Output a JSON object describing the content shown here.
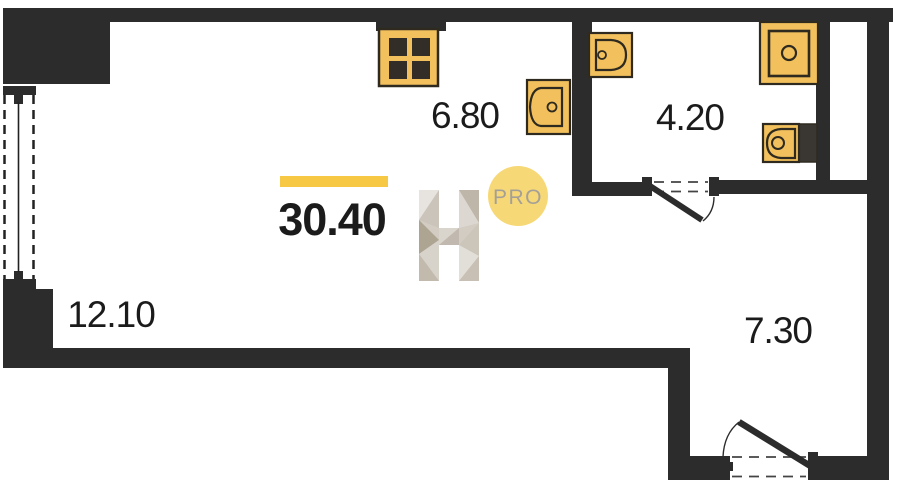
{
  "floorplan": {
    "total_area_value": "30.40",
    "badge_label": "PRO",
    "logo_letter": "H",
    "rooms": [
      {
        "id": "living-room",
        "area_label": "12.10"
      },
      {
        "id": "kitchen",
        "area_label": "6.80"
      },
      {
        "id": "bathroom",
        "area_label": "4.20"
      },
      {
        "id": "hallway",
        "area_label": "7.30"
      }
    ],
    "icons": {
      "stove": "four-burner-hob-icon",
      "kitchen_sink": "sink-basin-icon",
      "bathroom_sink": "sink-basin-icon",
      "shower": "shower-tray-icon",
      "toilet": "toilet-cistern-icon",
      "window": "window-icon",
      "bathroom_door": "door-swing-icon",
      "entry_door": "door-swing-icon"
    }
  },
  "colors": {
    "wall": "#2c2c2c",
    "fixture_fill": "#f2c05c",
    "fixture_outline": "#2e2a20",
    "burner": "#322e27",
    "toilet_tank": "#3a3631",
    "accent_bar": "#f7c843",
    "badge_fill": "#f7d877",
    "badge_text": "#a5a097",
    "area_text": "#1b1b1b",
    "logo_base": "#d2ccc3"
  }
}
